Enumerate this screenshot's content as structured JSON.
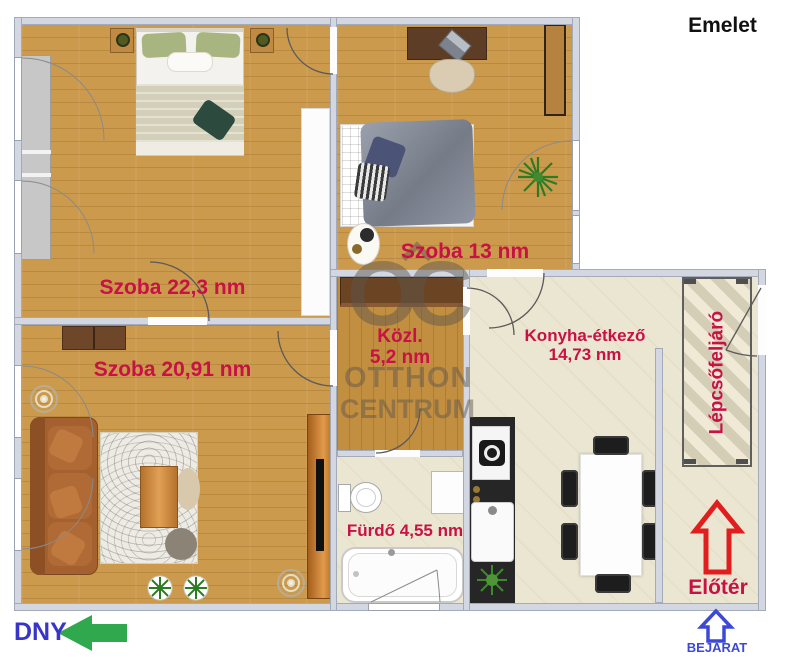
{
  "title": "Emelet",
  "rooms": {
    "bedroom1": {
      "label": "Szoba 22,3 nm"
    },
    "bedroom2": {
      "label": "Szoba 13 nm"
    },
    "living": {
      "label": "Szoba 20,91 nm"
    },
    "hall": {
      "line1": "Közl.",
      "line2": "5,2 nm"
    },
    "kitchen": {
      "line1": "Konyha-étkező",
      "line2": "14,73 nm"
    },
    "bath": {
      "label": "Fürdő 4,55 nm"
    },
    "stairs": {
      "label": "Lépcsőfeljáró"
    },
    "foyer": {
      "label": "Előtér"
    }
  },
  "compass": {
    "direction": "DNY"
  },
  "entrance": {
    "label": "BEJÁRAT"
  },
  "watermark": {
    "logo": "OC",
    "line1": "OTTHON",
    "line2": "CENTRUM"
  },
  "colors": {
    "label_red": "#c81144",
    "foyer_arrow_red": "#e11d1d",
    "compass_blue": "#3a35c9",
    "compass_arrow_green": "#2fa84e",
    "entrance_blue": "#3c49d6",
    "wall": "#d2d7e1",
    "wood_floor": "#cb9a4d",
    "tile_floor": "#ebe6d1",
    "title_black": "#111111"
  }
}
